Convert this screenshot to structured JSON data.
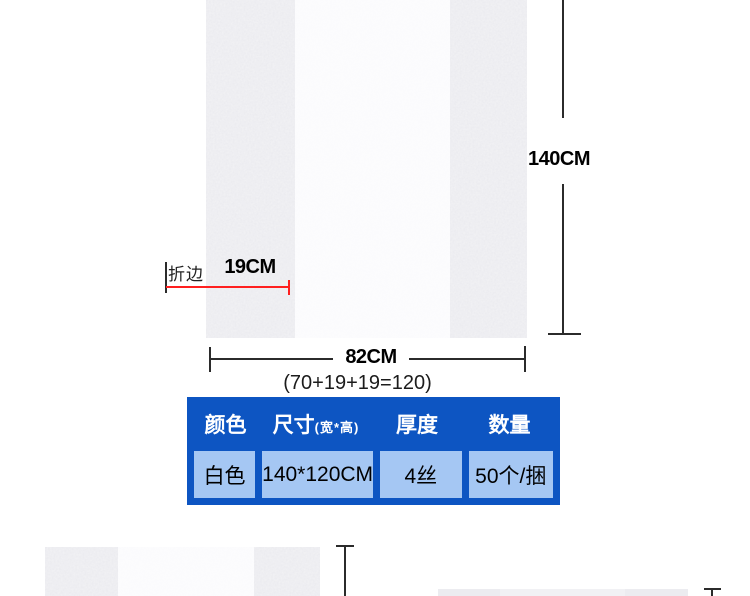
{
  "diagram": {
    "height_label": "140CM",
    "width_label": "82CM",
    "width_formula": "(70+19+19=120)",
    "fold_label": "折边",
    "fold_width_label": "19CM"
  },
  "spec_table": {
    "headers": [
      {
        "label": "颜色",
        "sub": ""
      },
      {
        "label": "尺寸",
        "sub": "(宽*高)"
      },
      {
        "label": "厚度",
        "sub": ""
      },
      {
        "label": "数量",
        "sub": ""
      }
    ],
    "row": {
      "color": "白色",
      "size": "140*120CM",
      "thickness": "4丝",
      "quantity": "50个/捆"
    }
  },
  "colors": {
    "table_border_blue": "#0d55c2",
    "table_cell_blue": "#a5c7f3",
    "table_header_text": "#ffffff",
    "dimension_line": "#2b2b2b",
    "fold_line_red": "#ff1f1f",
    "bag_gusset_gray": "#ececf0",
    "bag_center_white": "#fbfbfd"
  }
}
